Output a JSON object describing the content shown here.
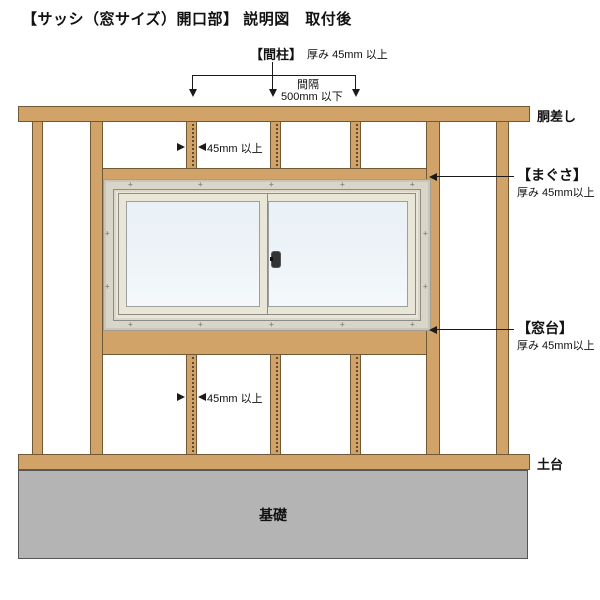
{
  "title": "【サッシ（窓サイズ）開口部】 説明図　取付後",
  "top_annotation": {
    "member_label": "【間柱】",
    "member_spec": "厚み 45mm 以上",
    "spacing_word": "間隔",
    "spacing_value": "500mm 以下"
  },
  "dimension_markers": {
    "upper_stud_width": "45mm 以上",
    "lower_stud_width": "45mm 以上"
  },
  "side_labels": {
    "girder": "胴差し",
    "header_label": "【まぐさ】",
    "header_spec": "厚み 45mm以上",
    "sill_label": "【窓台】",
    "sill_spec": "厚み 45mm以上",
    "ground_sill": "土台",
    "foundation": "基礎"
  },
  "icons": {
    "screw_mark": "+"
  },
  "colors": {
    "wood": "#d1a369",
    "wood_border": "#6e5835",
    "foundation": "#b4b4b4",
    "foundation_border": "#555555",
    "frame": "#d9d5c8",
    "sash": "#e9e6d8",
    "glass": "#eef4f8",
    "line": "#1a1a1a"
  }
}
